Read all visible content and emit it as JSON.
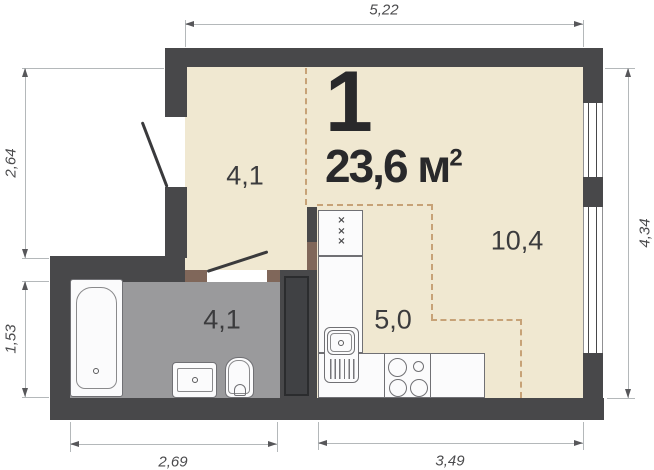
{
  "plan": {
    "unit_label": "1",
    "area": {
      "value": "23,6",
      "unit": " м",
      "sup": "2"
    },
    "rooms": [
      {
        "id": "hall",
        "area": "4,1"
      },
      {
        "id": "living",
        "area": "10,4"
      },
      {
        "id": "kitchen",
        "area": "5,0"
      },
      {
        "id": "bathroom",
        "area": "4,1"
      }
    ],
    "dimensions": {
      "top": "5,22",
      "left_upper": "2,64",
      "left_lower": "1,53",
      "right": "4,34",
      "bottom_left": "2,69",
      "bottom_right": "3,49"
    },
    "fixtures": [
      "bathtub",
      "washbasin",
      "toilet",
      "fridge",
      "kitchen-sink",
      "stove"
    ],
    "fridge_marks": [
      "×",
      "×",
      "×"
    ],
    "colors": {
      "wall": "#48484a",
      "floor_main": "#f0e8d1",
      "floor_bathroom": "#9a9a9c",
      "zone_dashed": "#c7a277",
      "door_jamb": "#80675a",
      "fixture_outline": "#707074",
      "dimension_line": "#b4b8ba",
      "text_dark": "#29292b"
    }
  }
}
